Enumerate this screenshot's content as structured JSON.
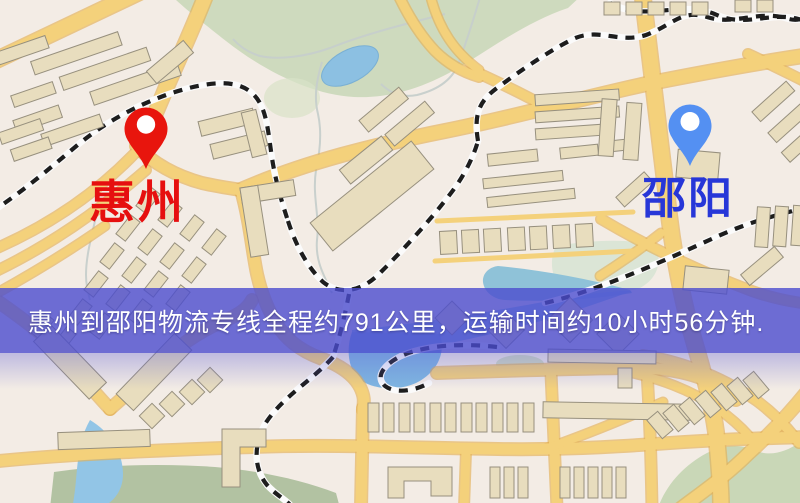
{
  "map": {
    "origin": {
      "name": "惠州",
      "label_color": "#e60f0f",
      "pin_color": "#e8150d"
    },
    "destination": {
      "name": "邵阳",
      "label_color": "#2737d8",
      "pin_color": "#5490f2"
    },
    "banner": {
      "text": "惠州到邵阳物流专线全程约791公里，运输时间约10小时56分钟.",
      "distance_km": "791",
      "duration": "10小时56分钟",
      "background_color": "#4b4cce",
      "text_color": "#ffffff"
    },
    "palette": {
      "background": "#f3ece5",
      "road": "#f4d17b",
      "road_casing": "#e3b156",
      "building_fill": "#e8ddbe",
      "building_outline": "#97907e",
      "park_green": "#cedabe",
      "field_green": "#b2c2a2",
      "water_blue": "#8cc0e2",
      "railway_dark": "#1d1d1d",
      "railway_light": "#fbfbfb"
    },
    "icons": {
      "origin_pin": "map-pin-icon",
      "destination_pin": "map-pin-icon"
    }
  }
}
